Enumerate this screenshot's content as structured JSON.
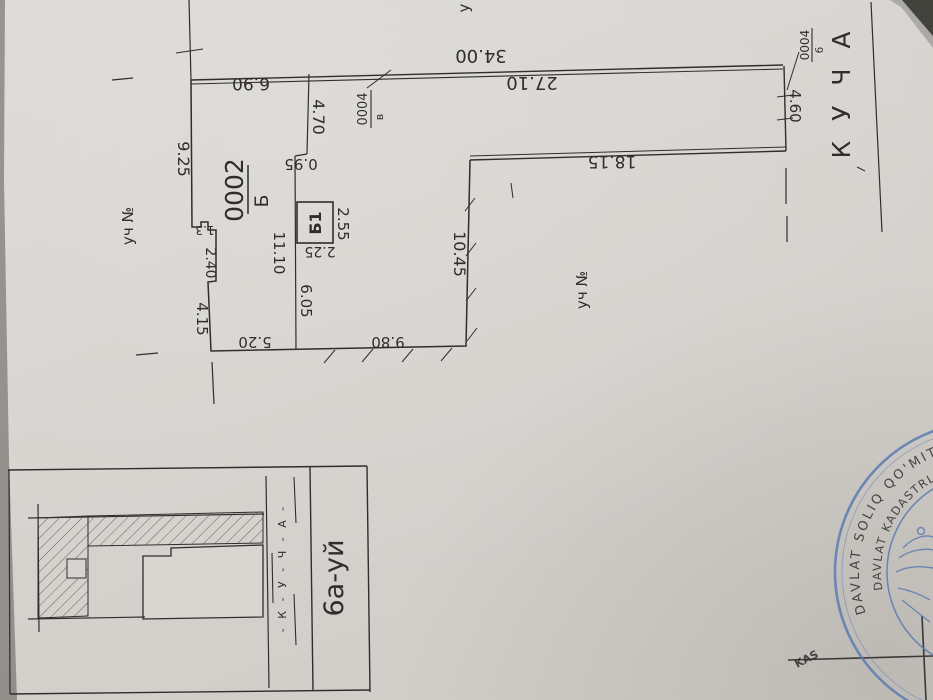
{
  "plan": {
    "street_name": "К У Ч А",
    "upper_neighbor_partial": "у",
    "left_neighbor_label": "уч №",
    "bottom_neighbor_label": "уч №",
    "parcel_number": "0002",
    "parcel_letter": "Б",
    "building_label": "Б1",
    "code_left": "0004",
    "code_left_letter": "в",
    "code_right": "0004",
    "code_right_letter": "б",
    "dims": {
      "street_front": "34.00",
      "top_right": "27.10",
      "top_left": "6.90",
      "inner_top": "18.15",
      "right_side": "4.60",
      "left_upper": "9.25",
      "entry_depth": "4.70",
      "jog": "0.95",
      "step_small": "1.3",
      "step": "2.40",
      "left_lower": "4.15",
      "bottom_left": "5.20",
      "bottom_right": "9.80",
      "inner_upper": "11.10",
      "inner_lower": "6.05",
      "building_side": "2.55",
      "building_bottom": "2.25",
      "inner_right": "10.45"
    }
  },
  "inset": {
    "house_label": "6а-уй",
    "street_letters": "- К - У - Ч - А -"
  },
  "stamp": {
    "outer_text": "DAVLAT SOLIQ QO'MITASI",
    "inner_text": "DAVLAT KADASTRLARI PAL",
    "corner_fragment": "KAS"
  },
  "colors": {
    "paper": "#d8d5d1",
    "ink": "#2f2e2c",
    "stamp_blue": "#5d7cb2"
  }
}
